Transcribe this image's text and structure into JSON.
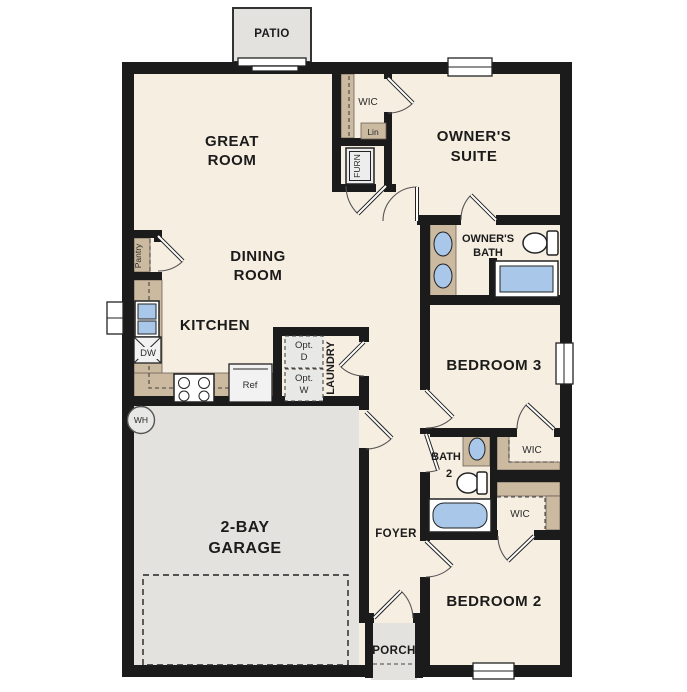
{
  "title": "Single-story floor plan",
  "labels": {
    "patio": "PATIO",
    "great_room": {
      "line1": "GREAT",
      "line2": "ROOM"
    },
    "owners_suite": {
      "line1": "OWNER'S",
      "line2": "SUITE"
    },
    "owners_bath": {
      "line1": "OWNER'S",
      "line2": "BATH"
    },
    "dining_room": {
      "line1": "DINING",
      "line2": "ROOM"
    },
    "kitchen": "KITCHEN",
    "garage": {
      "line1": "2-BAY",
      "line2": "GARAGE"
    },
    "laundry": "LAUNDRY",
    "bedroom3": "BEDROOM 3",
    "bedroom2": "BEDROOM 2",
    "foyer": "FOYER",
    "porch": "PORCH",
    "bath2": {
      "line1": "BATH",
      "line2": "2"
    },
    "wic_owner": "WIC",
    "wic_bed3": "WIC",
    "wic_bed2": "WIC",
    "lin": "Lin",
    "furn": "FURN",
    "pantry": "Pantry",
    "dw": "DW",
    "ref": "Ref",
    "wh": "WH",
    "opt_d": {
      "line1": "Opt.",
      "line2": "D"
    },
    "opt_w": {
      "line1": "Opt.",
      "line2": "W"
    }
  },
  "colors": {
    "wall": "#1b1b1b",
    "floor": "#f6eee1",
    "outdoor_gray": "#e3e2df",
    "cabinet_tan": "#cbb9a0",
    "fixture_blue": "#a9c8e9",
    "background": "#ffffff"
  }
}
